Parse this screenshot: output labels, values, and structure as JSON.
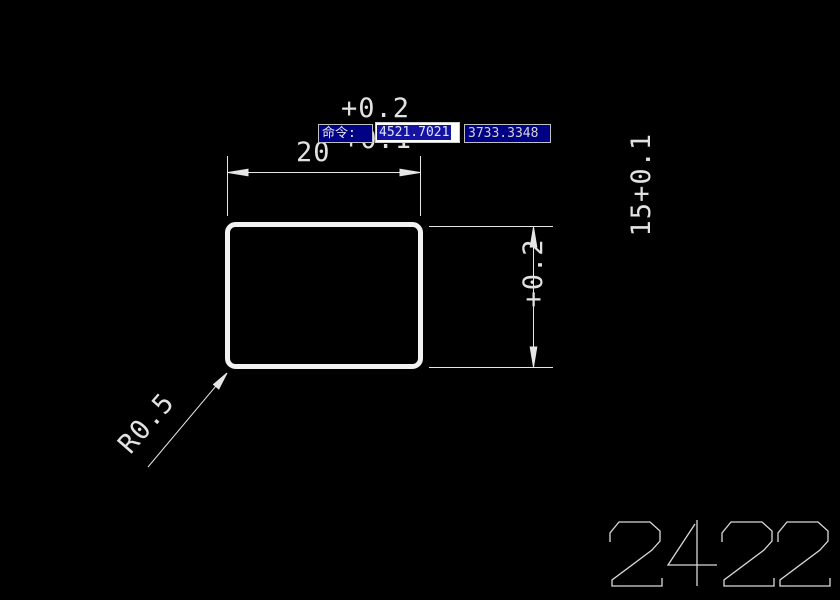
{
  "app": {
    "type": "cad-drawing-view",
    "background_color": "#000000",
    "line_color": "#e6e6e6"
  },
  "command_bar": {
    "prompt": "命令:",
    "coord_x": "4521.7021",
    "coord_y": "3733.3348",
    "colors": {
      "box_bg": "#000085",
      "box_border": "#c0c0c0",
      "field_bg": "#ffffff",
      "selection_bg": "#1414a0",
      "selected_text": "#dfe4ff",
      "text": "#e8e8e8"
    }
  },
  "drawing": {
    "shape": "rounded-rectangle",
    "dim_width": {
      "value": "20",
      "upper_tol": "+0.2",
      "lower_tol": "+0.1"
    },
    "dim_height": {
      "value": "15",
      "upper_tol": "+0.2",
      "lower_tol": "+0.1"
    },
    "radius_label": "R0.5",
    "part_number": "2422"
  }
}
